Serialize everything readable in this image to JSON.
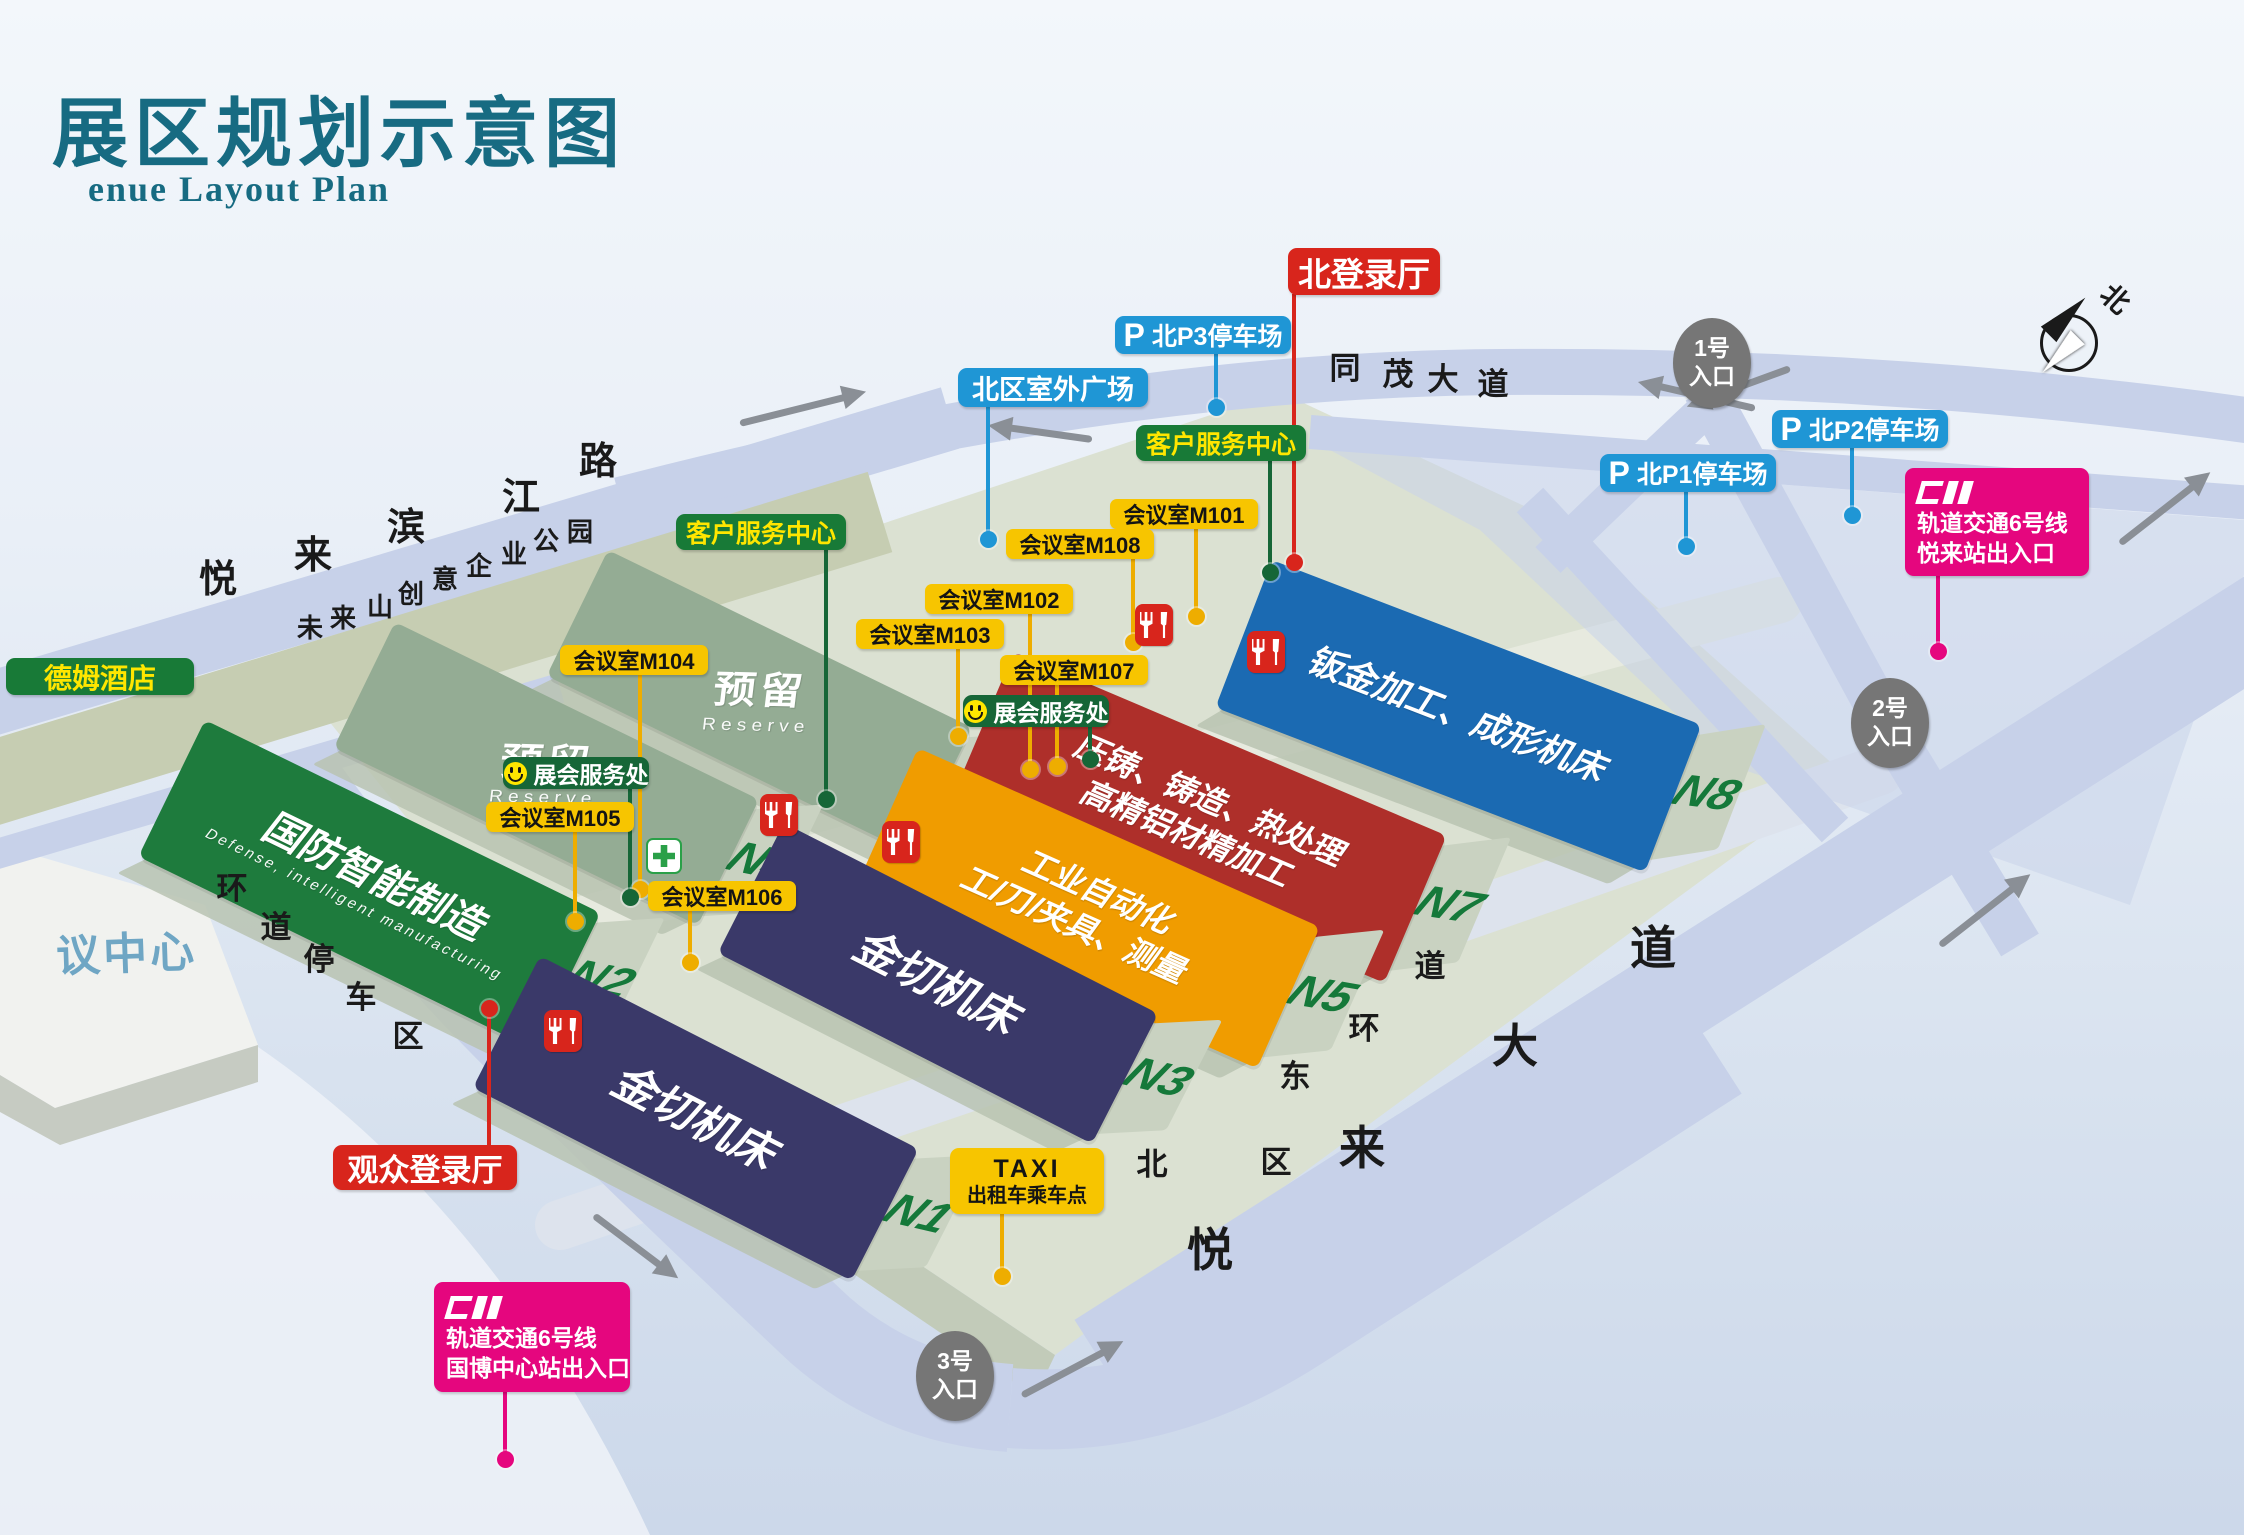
{
  "title": {
    "cn": "展区规划示意图",
    "en": "enue Layout Plan"
  },
  "map": {
    "compass_label": "北",
    "convention_center": "议中心",
    "p_glyph": "P",
    "halls": [
      {
        "n": "N6",
        "x": 608,
        "y": 550,
        "w": 405,
        "h": 140,
        "rot": 26,
        "color": "#94ac94",
        "reserve": true,
        "lines": [
          "预留"
        ],
        "en": "Reserve"
      },
      {
        "n": "N4",
        "x": 395,
        "y": 622,
        "w": 405,
        "h": 140,
        "rot": 26,
        "color": "#94ac94",
        "reserve": true,
        "lines": [
          "预留"
        ],
        "en": "Reserve"
      },
      {
        "n": "N8",
        "x": 1272,
        "y": 560,
        "w": 460,
        "h": 158,
        "rot": 21,
        "color": "#1b6ab2",
        "lines": [
          "钣金加工、成形机床"
        ],
        "fs": 35
      },
      {
        "n": "N2",
        "x": 205,
        "y": 720,
        "w": 440,
        "h": 152,
        "rot": 26,
        "color": "#1e7b3d",
        "lines": [
          "国防智能制造"
        ],
        "en": "Defense, intelligent manufacturing",
        "fs": 40
      },
      {
        "n": "N7",
        "x": 1014,
        "y": 652,
        "w": 470,
        "h": 160,
        "rot": 23,
        "color": "#ae2f2a",
        "lines": [
          "压铸、铸造、热处理",
          "高精铝材精加工"
        ],
        "fs": 32
      },
      {
        "n": "N5",
        "x": 918,
        "y": 748,
        "w": 440,
        "h": 155,
        "rot": 24,
        "color": "#f09c00",
        "lines": [
          "工业自动化",
          "工/刀/夹具、测量"
        ],
        "fs": 32
      },
      {
        "n": "N3",
        "x": 784,
        "y": 823,
        "w": 420,
        "h": 146,
        "rot": 27,
        "color": "#3a3969",
        "lines": [
          "金切机床"
        ],
        "fs": 44
      },
      {
        "n": "N1",
        "x": 540,
        "y": 956,
        "w": 425,
        "h": 148,
        "rot": 27,
        "color": "#3a3969",
        "lines": [
          "金切机床"
        ],
        "fs": 44
      }
    ],
    "pins": [
      {
        "name": "north-login-hall",
        "type": "red",
        "text": "北登录厅",
        "x": 1288,
        "y": 248,
        "w": 152,
        "h": 47,
        "fs": 33,
        "line": {
          "x": 1294,
          "y1": 294,
          "y2": 560
        },
        "dot": [
          1294,
          562
        ]
      },
      {
        "name": "visitor-login-hall",
        "type": "red",
        "text": "观众登录厅",
        "x": 333,
        "y": 1145,
        "w": 184,
        "h": 45,
        "fs": 31,
        "line": {
          "x": 489,
          "y1": 1008,
          "y2": 1145
        },
        "dot": [
          489,
          1008
        ]
      },
      {
        "name": "p3-parking",
        "type": "bluep",
        "text": "北P3停车场",
        "x": 1115,
        "y": 316,
        "w": 176,
        "h": 38,
        "fs": 25,
        "line": {
          "x": 1216,
          "y1": 353,
          "y2": 405
        },
        "dot": [
          1216,
          407
        ]
      },
      {
        "name": "p2-parking",
        "type": "bluep",
        "text": "北P2停车场",
        "x": 1772,
        "y": 410,
        "w": 176,
        "h": 38,
        "fs": 25,
        "line": {
          "x": 1852,
          "y1": 447,
          "y2": 513
        },
        "dot": [
          1852,
          515
        ]
      },
      {
        "name": "p1-parking",
        "type": "bluep",
        "text": "北P1停车场",
        "x": 1600,
        "y": 454,
        "w": 176,
        "h": 38,
        "fs": 25,
        "line": {
          "x": 1686,
          "y1": 491,
          "y2": 544
        },
        "dot": [
          1686,
          546
        ]
      },
      {
        "name": "north-outdoor-plaza",
        "type": "blue",
        "text": "北区室外广场",
        "x": 958,
        "y": 368,
        "w": 190,
        "h": 39,
        "fs": 27,
        "line": {
          "x": 988,
          "y1": 406,
          "y2": 536
        },
        "dot": [
          988,
          539
        ]
      },
      {
        "name": "customer-service-west",
        "type": "green",
        "text": "客户服务中心",
        "x": 676,
        "y": 514,
        "w": 170,
        "h": 36,
        "fs": 25,
        "line": {
          "x": 826,
          "y1": 549,
          "y2": 797
        },
        "dot": [
          826,
          799
        ]
      },
      {
        "name": "customer-service-east",
        "type": "green",
        "text": "客户服务中心",
        "x": 1136,
        "y": 425,
        "w": 170,
        "h": 36,
        "fs": 25,
        "line": {
          "x": 1270,
          "y1": 460,
          "y2": 570
        },
        "dot": [
          1270,
          572
        ]
      },
      {
        "name": "dem-hotel",
        "type": "green",
        "text": "德姆酒店",
        "x": 6,
        "y": 658,
        "w": 188,
        "h": 37,
        "fs": 28
      },
      {
        "name": "meeting-room-m101",
        "type": "yellow",
        "text": "会议室M101",
        "x": 1110,
        "y": 499,
        "w": 148,
        "h": 30,
        "fs": 22,
        "line": {
          "x": 1196,
          "y1": 528,
          "y2": 614
        },
        "dot": [
          1196,
          616
        ]
      },
      {
        "name": "meeting-room-m108",
        "type": "yellow",
        "text": "会议室M108",
        "x": 1006,
        "y": 529,
        "w": 148,
        "h": 30,
        "fs": 22,
        "line": {
          "x": 1133,
          "y1": 558,
          "y2": 640
        },
        "dot": [
          1133,
          642
        ]
      },
      {
        "name": "meeting-room-m102",
        "type": "yellow",
        "text": "会议室M102",
        "x": 925,
        "y": 584,
        "w": 148,
        "h": 30,
        "fs": 22,
        "line": {
          "x": 1030,
          "y1": 613,
          "y2": 767
        },
        "dot": [
          1030,
          769
        ]
      },
      {
        "name": "meeting-room-m103",
        "type": "yellow",
        "text": "会议室M103",
        "x": 856,
        "y": 619,
        "w": 148,
        "h": 30,
        "fs": 22,
        "line": {
          "x": 958,
          "y1": 648,
          "y2": 734
        },
        "dot": [
          958,
          736
        ]
      },
      {
        "name": "meeting-room-m107",
        "type": "yellow",
        "text": "会议室M107",
        "x": 1000,
        "y": 655,
        "w": 148,
        "h": 30,
        "fs": 22,
        "line": {
          "x": 1057,
          "y1": 684,
          "y2": 764
        },
        "dot": [
          1057,
          766
        ]
      },
      {
        "name": "meeting-room-m104",
        "type": "yellow",
        "text": "会议室M104",
        "x": 560,
        "y": 645,
        "w": 148,
        "h": 30,
        "fs": 22,
        "line": {
          "x": 640,
          "y1": 674,
          "y2": 887
        },
        "dot": [
          640,
          889
        ]
      },
      {
        "name": "meeting-room-m105",
        "type": "yellow",
        "text": "会议室M105",
        "x": 486,
        "y": 802,
        "w": 148,
        "h": 30,
        "fs": 22,
        "line": {
          "x": 575,
          "y1": 831,
          "y2": 919
        },
        "dot": [
          575,
          921
        ]
      },
      {
        "name": "meeting-room-m106",
        "type": "yellow",
        "text": "会议室M106",
        "x": 648,
        "y": 881,
        "w": 148,
        "h": 30,
        "fs": 22,
        "line": {
          "x": 690,
          "y1": 910,
          "y2": 960
        },
        "dot": [
          690,
          962
        ]
      },
      {
        "name": "expo-service-west",
        "type": "darkgreen",
        "smiley": true,
        "text": "展会服务处",
        "x": 503,
        "y": 757,
        "w": 146,
        "h": 32,
        "fs": 23,
        "line": {
          "x": 630,
          "y1": 788,
          "y2": 895
        },
        "dot": [
          630,
          897
        ]
      },
      {
        "name": "expo-service-east",
        "type": "darkgreen",
        "smiley": true,
        "text": "展会服务处",
        "x": 963,
        "y": 695,
        "w": 146,
        "h": 32,
        "fs": 23,
        "line": {
          "x": 1090,
          "y1": 726,
          "y2": 757
        },
        "dot": [
          1090,
          759
        ]
      },
      {
        "name": "taxi-stand",
        "type": "taxi",
        "lines": [
          "TAXI",
          "出租车乘车点"
        ],
        "x": 950,
        "y": 1148,
        "w": 154,
        "h": 66,
        "line": {
          "x": 1002,
          "y1": 1213,
          "y2": 1273
        },
        "dot": [
          1002,
          1276
        ]
      },
      {
        "name": "metro-line6-yuelai-station",
        "type": "pink",
        "lines": [
          "轨道交通6号线",
          "悦来站出入口"
        ],
        "x": 1905,
        "y": 468,
        "w": 184,
        "h": 108,
        "line": {
          "x": 1938,
          "y1": 575,
          "y2": 648
        },
        "dot": [
          1938,
          651
        ]
      },
      {
        "name": "metro-line6-expo-center-station",
        "type": "pink",
        "lines": [
          "轨道交通6号线",
          "国博中心站出入口"
        ],
        "x": 434,
        "y": 1282,
        "w": 196,
        "h": 110,
        "line": {
          "x": 505,
          "y1": 1391,
          "y2": 1456
        },
        "dot": [
          505,
          1459
        ]
      }
    ],
    "entrances": [
      {
        "name": "entrance-1",
        "lines": [
          "1号",
          "入口"
        ],
        "x": 1712,
        "y": 363
      },
      {
        "name": "entrance-2",
        "lines": [
          "2号",
          "入口"
        ],
        "x": 1890,
        "y": 723
      },
      {
        "name": "entrance-3",
        "lines": [
          "3号",
          "入口"
        ],
        "x": 955,
        "y": 1376
      }
    ],
    "road_names": [
      {
        "name": "yuelai-binjiang-road",
        "text": "悦来滨江路",
        "size": 38,
        "chars": [
          {
            "t": "悦",
            "x": 218,
            "y": 580
          },
          {
            "t": "来",
            "x": 313,
            "y": 556
          },
          {
            "t": "滨",
            "x": 406,
            "y": 528
          },
          {
            "t": "江",
            "x": 521,
            "y": 498
          },
          {
            "t": "路",
            "x": 598,
            "y": 462
          }
        ]
      },
      {
        "name": "weilaishan-creative-park",
        "text": "未来山创意企业公园",
        "size": 26,
        "chars": [
          {
            "t": "未",
            "x": 310,
            "y": 628
          },
          {
            "t": "来",
            "x": 343,
            "y": 618
          },
          {
            "t": "山",
            "x": 380,
            "y": 607
          },
          {
            "t": "创",
            "x": 411,
            "y": 594
          },
          {
            "t": "意",
            "x": 445,
            "y": 579
          },
          {
            "t": "企",
            "x": 479,
            "y": 566
          },
          {
            "t": "业",
            "x": 514,
            "y": 554
          },
          {
            "t": "公",
            "x": 546,
            "y": 541
          },
          {
            "t": "园",
            "x": 580,
            "y": 532
          }
        ]
      },
      {
        "name": "tongmao-avenue",
        "text": "同茂大道",
        "size": 31,
        "chars": [
          {
            "t": "同",
            "x": 1345,
            "y": 368
          },
          {
            "t": "茂",
            "x": 1398,
            "y": 374
          },
          {
            "t": "大",
            "x": 1443,
            "y": 379
          },
          {
            "t": "道",
            "x": 1493,
            "y": 384
          }
        ]
      },
      {
        "name": "yuelai-avenue",
        "text": "悦来大道",
        "size": 46,
        "chars": [
          {
            "t": "悦",
            "x": 1210,
            "y": 1250
          },
          {
            "t": "来",
            "x": 1362,
            "y": 1148
          },
          {
            "t": "大",
            "x": 1515,
            "y": 1046
          },
          {
            "t": "道",
            "x": 1653,
            "y": 948
          }
        ]
      },
      {
        "name": "north-east-ring-road",
        "text": "北区东环道",
        "size": 31,
        "chars": [
          {
            "t": "道",
            "x": 1430,
            "y": 966
          },
          {
            "t": "环",
            "x": 1364,
            "y": 1028
          },
          {
            "t": "东",
            "x": 1295,
            "y": 1076
          },
          {
            "t": "区",
            "x": 1276,
            "y": 1162
          },
          {
            "t": "北",
            "x": 1152,
            "y": 1164
          }
        ]
      },
      {
        "name": "ring-road-parking-area",
        "text": "环道停车区",
        "size": 31,
        "chars": [
          {
            "t": "环",
            "x": 232,
            "y": 888
          },
          {
            "t": "道",
            "x": 276,
            "y": 927
          },
          {
            "t": "停",
            "x": 319,
            "y": 959
          },
          {
            "t": "车",
            "x": 361,
            "y": 997
          },
          {
            "t": "区",
            "x": 408,
            "y": 1036
          }
        ]
      }
    ],
    "food_icons": [
      {
        "name": "restaurant-icon",
        "x": 760,
        "y": 794
      },
      {
        "name": "restaurant-icon",
        "x": 882,
        "y": 821
      },
      {
        "name": "restaurant-icon",
        "x": 1135,
        "y": 604
      },
      {
        "name": "restaurant-icon",
        "x": 1247,
        "y": 631
      },
      {
        "name": "restaurant-icon",
        "x": 544,
        "y": 1010
      }
    ],
    "medical_icons": [
      {
        "name": "medical-aid-icon",
        "x": 646,
        "y": 838
      }
    ],
    "arrows": [
      {
        "x": 740,
        "y": 420,
        "len": 110,
        "rot": -14
      },
      {
        "x": 1755,
        "y": 405,
        "len": 100,
        "rot": 193
      },
      {
        "x": 1790,
        "y": 365,
        "len": 90,
        "rot": 160
      },
      {
        "x": 2120,
        "y": 540,
        "len": 95,
        "rot": -38
      },
      {
        "x": 1940,
        "y": 942,
        "len": 95,
        "rot": -38
      },
      {
        "x": 594,
        "y": 1212,
        "len": 85,
        "rot": 37
      },
      {
        "x": 1022,
        "y": 1392,
        "len": 95,
        "rot": -28
      },
      {
        "x": 1092,
        "y": 436,
        "len": 85,
        "rot": 188
      }
    ]
  }
}
